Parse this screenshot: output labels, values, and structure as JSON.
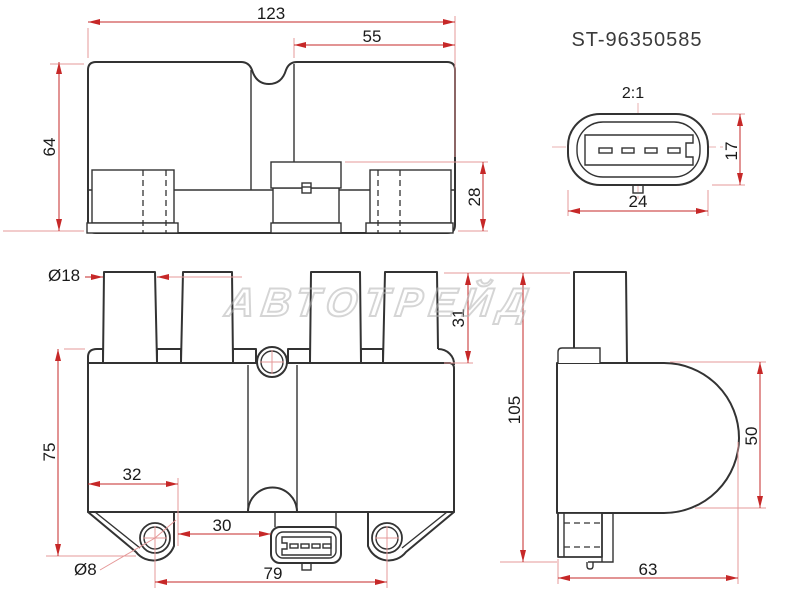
{
  "title": {
    "part_number": "ST-96350585"
  },
  "watermark": {
    "text": "АВТОТРЕЙД"
  },
  "colors": {
    "line": "#333333",
    "dimension_red": "#c62828",
    "extension_pink": "#e59898",
    "text": "#1a1a1a"
  },
  "views": {
    "top": {
      "dims": {
        "overall_width": "123",
        "right_section_width": "55",
        "overall_depth": "64",
        "connector_block_height": "28"
      }
    },
    "connector_detail": {
      "scale": "2:1",
      "pin_count": 4,
      "dims": {
        "width": "24",
        "height": "17"
      }
    },
    "front": {
      "dims": {
        "tower_diameter": "Ø18",
        "tower_height": "31",
        "body_height": "75",
        "mount_hole_offset": "32",
        "connector_offset": "30",
        "mount_hole_diameter": "Ø8",
        "mount_hole_spacing": "79",
        "overall_height": "105"
      }
    },
    "side": {
      "dims": {
        "round_body_height": "50",
        "overall_depth": "63"
      }
    }
  }
}
